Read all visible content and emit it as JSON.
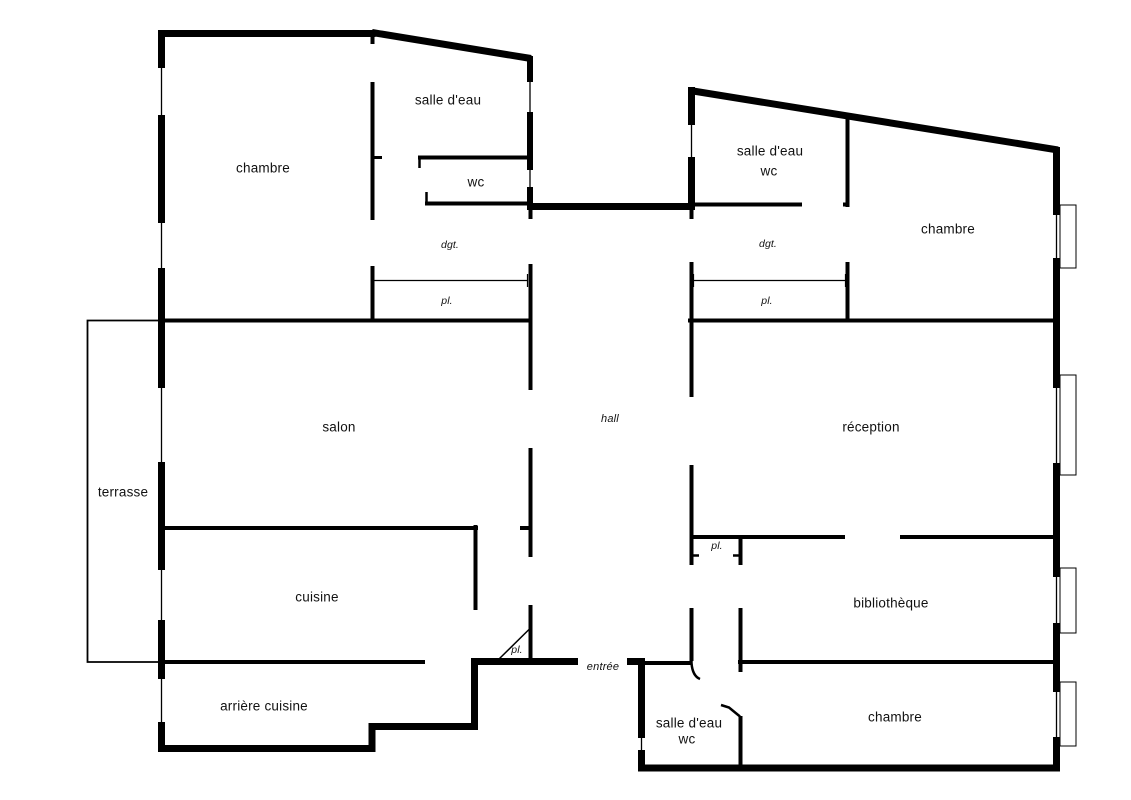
{
  "floorplan": {
    "labels": {
      "chambre_nw": "chambre",
      "salle_eau_nw": "salle d'eau",
      "wc_nw": "wc",
      "dgt_left": "dgt.",
      "pl_left": "pl.",
      "salle_eau_ne": "salle d'eau",
      "wc_ne": "wc",
      "chambre_ne": "chambre",
      "dgt_right": "dgt.",
      "pl_right": "pl.",
      "terrasse": "terrasse",
      "salon": "salon",
      "hall": "hall",
      "reception": "réception",
      "pl_reception": "pl.",
      "cuisine": "cuisine",
      "bibliotheque": "bibliothèque",
      "pl_hall": "pl.",
      "entree": "entrée",
      "arriere_cuisine": "arrière cuisine",
      "salle_eau_s": "salle d'eau",
      "wc_s": "wc",
      "chambre_se": "chambre"
    },
    "colors": {
      "wall": "#000000",
      "background": "#ffffff",
      "label": "#111111"
    }
  }
}
